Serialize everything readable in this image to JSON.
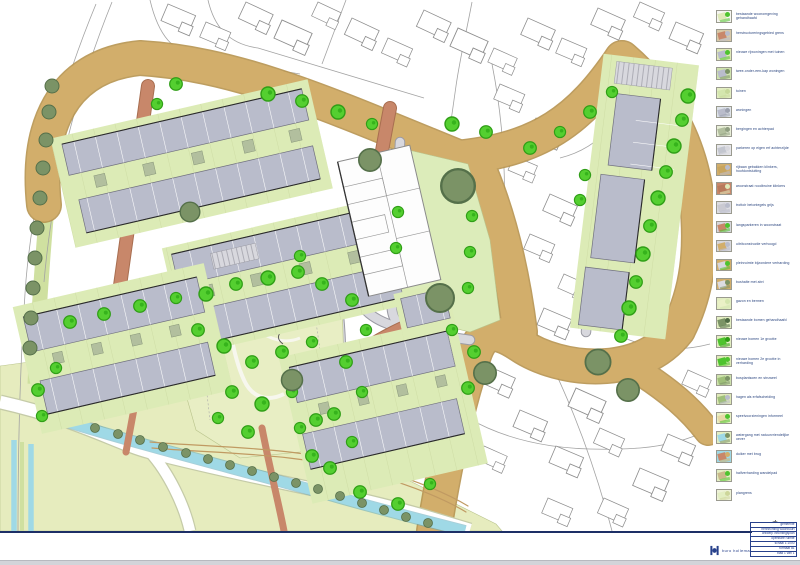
{
  "colors": {
    "sheet": "#ffffff",
    "navy_border": "#1d2f66",
    "main_road_tan": "#d2ae6b",
    "street_terracotta": "#c8876a",
    "street_gray": "#d8d8de",
    "building_gray": "#b9bccb",
    "garden_green": "#dcebb6",
    "park_green": "#e8eec4",
    "field_green": "#e6ecbe",
    "tree_bright": "#54cf30",
    "tree_olive": "#7b9366",
    "water_cyan": "#9fd9e6",
    "legend_text": "#25407c"
  },
  "legend": {
    "items": [
      {
        "label": "bestaande woonomgeving gehandhaafd",
        "c1": "#f6f6f2",
        "c2": "#dfe9b8",
        "c3": "#4ec32e"
      },
      {
        "label": "herstructureringsgebied grens",
        "c1": "#d8c9a8",
        "c2": "#c8876a",
        "c3": "#b9bccb"
      },
      {
        "label": "nieuwe rijwoningen met tuinen",
        "c1": "#dfe9b8",
        "c2": "#b9bccb",
        "c3": "#4ec32e"
      },
      {
        "label": "twee-onder-een-kap woningen",
        "c1": "#cfe3ae",
        "c2": "#b9bccb",
        "c3": "#7b9366"
      },
      {
        "label": "tuinen",
        "c1": "#e3eec2",
        "c2": "#d4e6ae",
        "c3": "#c6d89a"
      },
      {
        "label": "woningen",
        "c1": "#dfe4ea",
        "c2": "#b9bccb",
        "c3": "#9ba0ae"
      },
      {
        "label": "bergingen en achterpad",
        "c1": "#e9efd8",
        "c2": "#b2bf9e",
        "c3": "#8f9e80"
      },
      {
        "label": "parkeren op eigen erf achterzijde",
        "c1": "#e6e6ea",
        "c2": "#c3c6cf",
        "c3": "#d8d8de"
      },
      {
        "label": "rijbaan gebakken klinkers, hoofdontsluiting",
        "c1": "#d2ae6b",
        "c2": "#c8a55f",
        "c3": "#b9bccb"
      },
      {
        "label": "woonstraat roodbruine klinkers",
        "c1": "#c8876a",
        "c2": "#b87a5c",
        "c3": "#dfe9b8"
      },
      {
        "label": "trottoir betontegels grijs",
        "c1": "#dcdce2",
        "c2": "#cacad2",
        "c3": "#b9bccb"
      },
      {
        "label": "langsparkeren in woonstraat",
        "c1": "#d7d7dd",
        "c2": "#c8876a",
        "c3": "#4ec32e"
      },
      {
        "label": "uitritconstructie verhoogd",
        "c1": "#d7d7dd",
        "c2": "#d2ae6b",
        "c3": "#b9bccb"
      },
      {
        "label": "pleinruimte bijzondere verharding",
        "c1": "#d2ae6b",
        "c2": "#d7d7dd",
        "c3": "#4ec32e"
      },
      {
        "label": "bushalte met abri",
        "c1": "#d2ae6b",
        "c2": "#dcdce2",
        "c3": "#7b9366"
      },
      {
        "label": "gazon en bermen",
        "c1": "#e3eec2",
        "c2": "#eaf1c6",
        "c3": "#d4e6ae"
      },
      {
        "label": "bestaande bomen gehandhaafd",
        "c1": "#e3eec2",
        "c2": "#7b9366",
        "c3": "#4f6b45"
      },
      {
        "label": "nieuwe bomen 1e grootte",
        "c1": "#e3eec2",
        "c2": "#4ec32e",
        "c3": "#2f9e16"
      },
      {
        "label": "nieuwe bomen 2e grootte in verharding",
        "c1": "#dfe9b8",
        "c2": "#4ec32e",
        "c3": "#4ec32e"
      },
      {
        "label": "bosplantsoen en struweel",
        "c1": "#cfe3ae",
        "c2": "#9fbf7a",
        "c3": "#7b9366"
      },
      {
        "label": "hagen als erfafscheiding",
        "c1": "#dfe9b8",
        "c2": "#9fbf7a",
        "c3": "#b9bccb"
      },
      {
        "label": "speelvoorzieningen informeel",
        "c1": "#eaf1c6",
        "c2": "#e7d9a8",
        "c3": "#4ec32e"
      },
      {
        "label": "watergang met natuurvriendelijke oever",
        "c1": "#e3eec2",
        "c2": "#9fd9e6",
        "c3": "#7b9366"
      },
      {
        "label": "duiker met brug",
        "c1": "#9fd9e6",
        "c2": "#c8876a",
        "c3": "#d2ae6b"
      },
      {
        "label": "halfverharding wandelpad",
        "c1": "#e3eec2",
        "c2": "#c9b98a",
        "c3": "#4ec32e"
      },
      {
        "label": "plangrens",
        "c1": "#eef2d8",
        "c2": "#e3eec2",
        "c3": "#cdd69a"
      }
    ]
  },
  "title_block": {
    "rows": [
      "gemeente",
      "herinrichting woonbuurt",
      "ontwerp inrichtingsplan",
      "openbare ruimte",
      "schaal 1:1000",
      "formaat a1",
      "blad 1 van 1"
    ],
    "logo_text": "buro hollema"
  }
}
